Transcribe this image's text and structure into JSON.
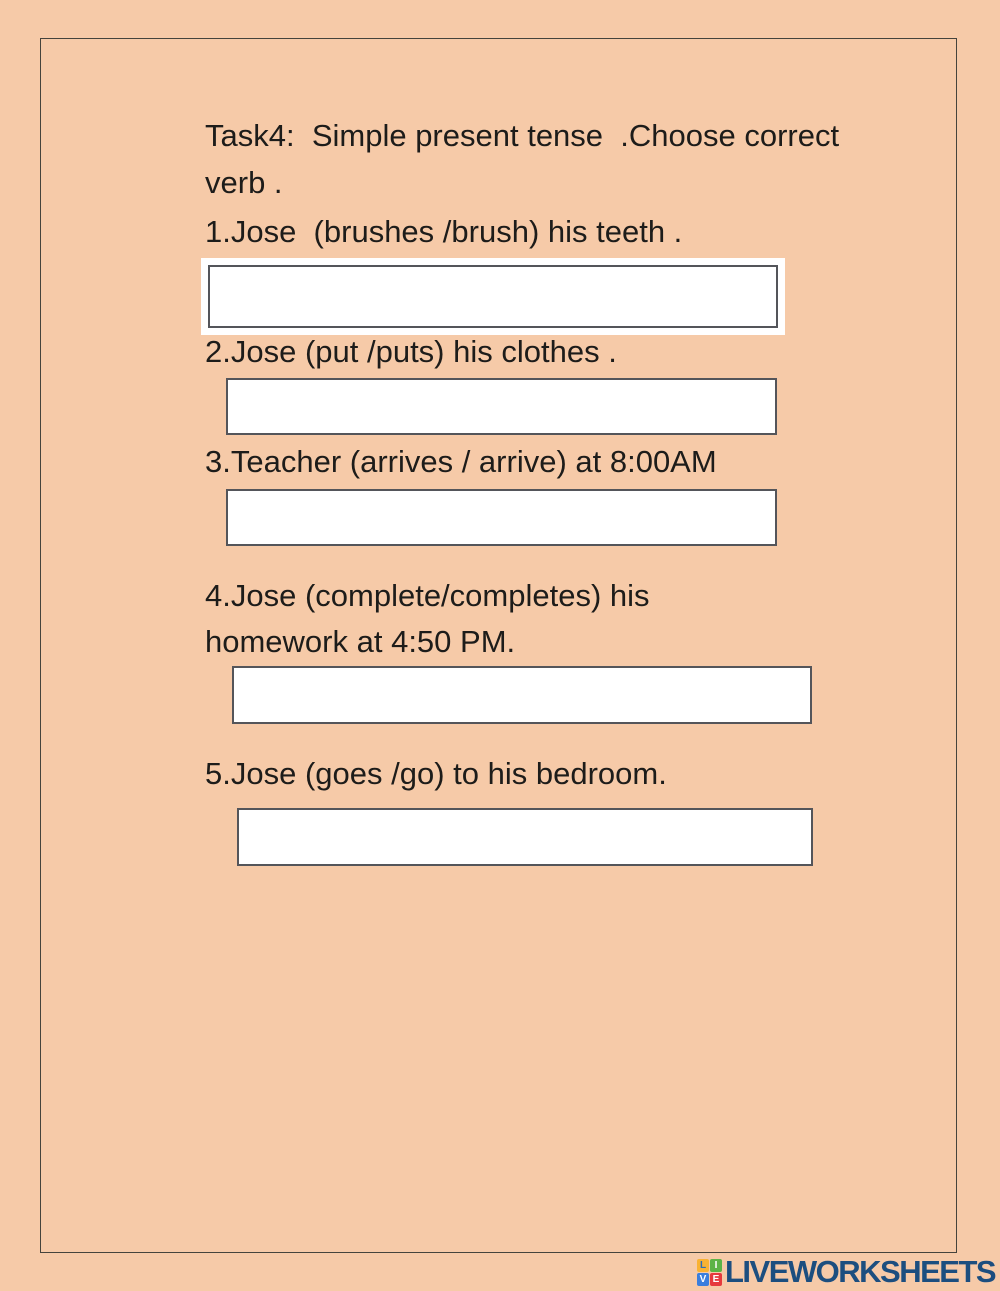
{
  "page": {
    "background_color": "#f6caa8",
    "frame_border_color": "#45433c",
    "text_color": "#1d1c1a",
    "input_border_color": "#54555a"
  },
  "worksheet": {
    "title_line1": "Task4:  Simple present tense  .Choose correct",
    "title_line2": "verb .",
    "questions": [
      {
        "number": "1",
        "lines": [
          "1.Jose  (brushes /brush) his teeth ."
        ],
        "answer_value": "",
        "answer_placeholder": ""
      },
      {
        "number": "2",
        "lines": [
          "2.Jose (put /puts) his clothes ."
        ],
        "answer_value": "",
        "answer_placeholder": ""
      },
      {
        "number": "3",
        "lines": [
          "3.Teacher (arrives / arrive) at 8:00AM"
        ],
        "answer_value": "",
        "answer_placeholder": ""
      },
      {
        "number": "4",
        "lines": [
          "4.Jose (complete/completes) his",
          "homework at 4:50 PM."
        ],
        "answer_value": "",
        "answer_placeholder": ""
      },
      {
        "number": "5",
        "lines": [
          "5.Jose (goes /go) to his bedroom."
        ],
        "answer_value": "",
        "answer_placeholder": ""
      }
    ]
  },
  "branding": {
    "logo_text": "LIVEWORKSHEETS",
    "logo_text_color": "#1c4e7f",
    "logo_tiles": [
      {
        "letter": "L",
        "bg": "#f9b233",
        "fg": "#2f6db4"
      },
      {
        "letter": "I",
        "bg": "#5cb346",
        "fg": "#ffffff"
      },
      {
        "letter": "V",
        "bg": "#3a7edd",
        "fg": "#ffffff"
      },
      {
        "letter": "E",
        "bg": "#e63a3d",
        "fg": "#ffffff"
      }
    ]
  }
}
